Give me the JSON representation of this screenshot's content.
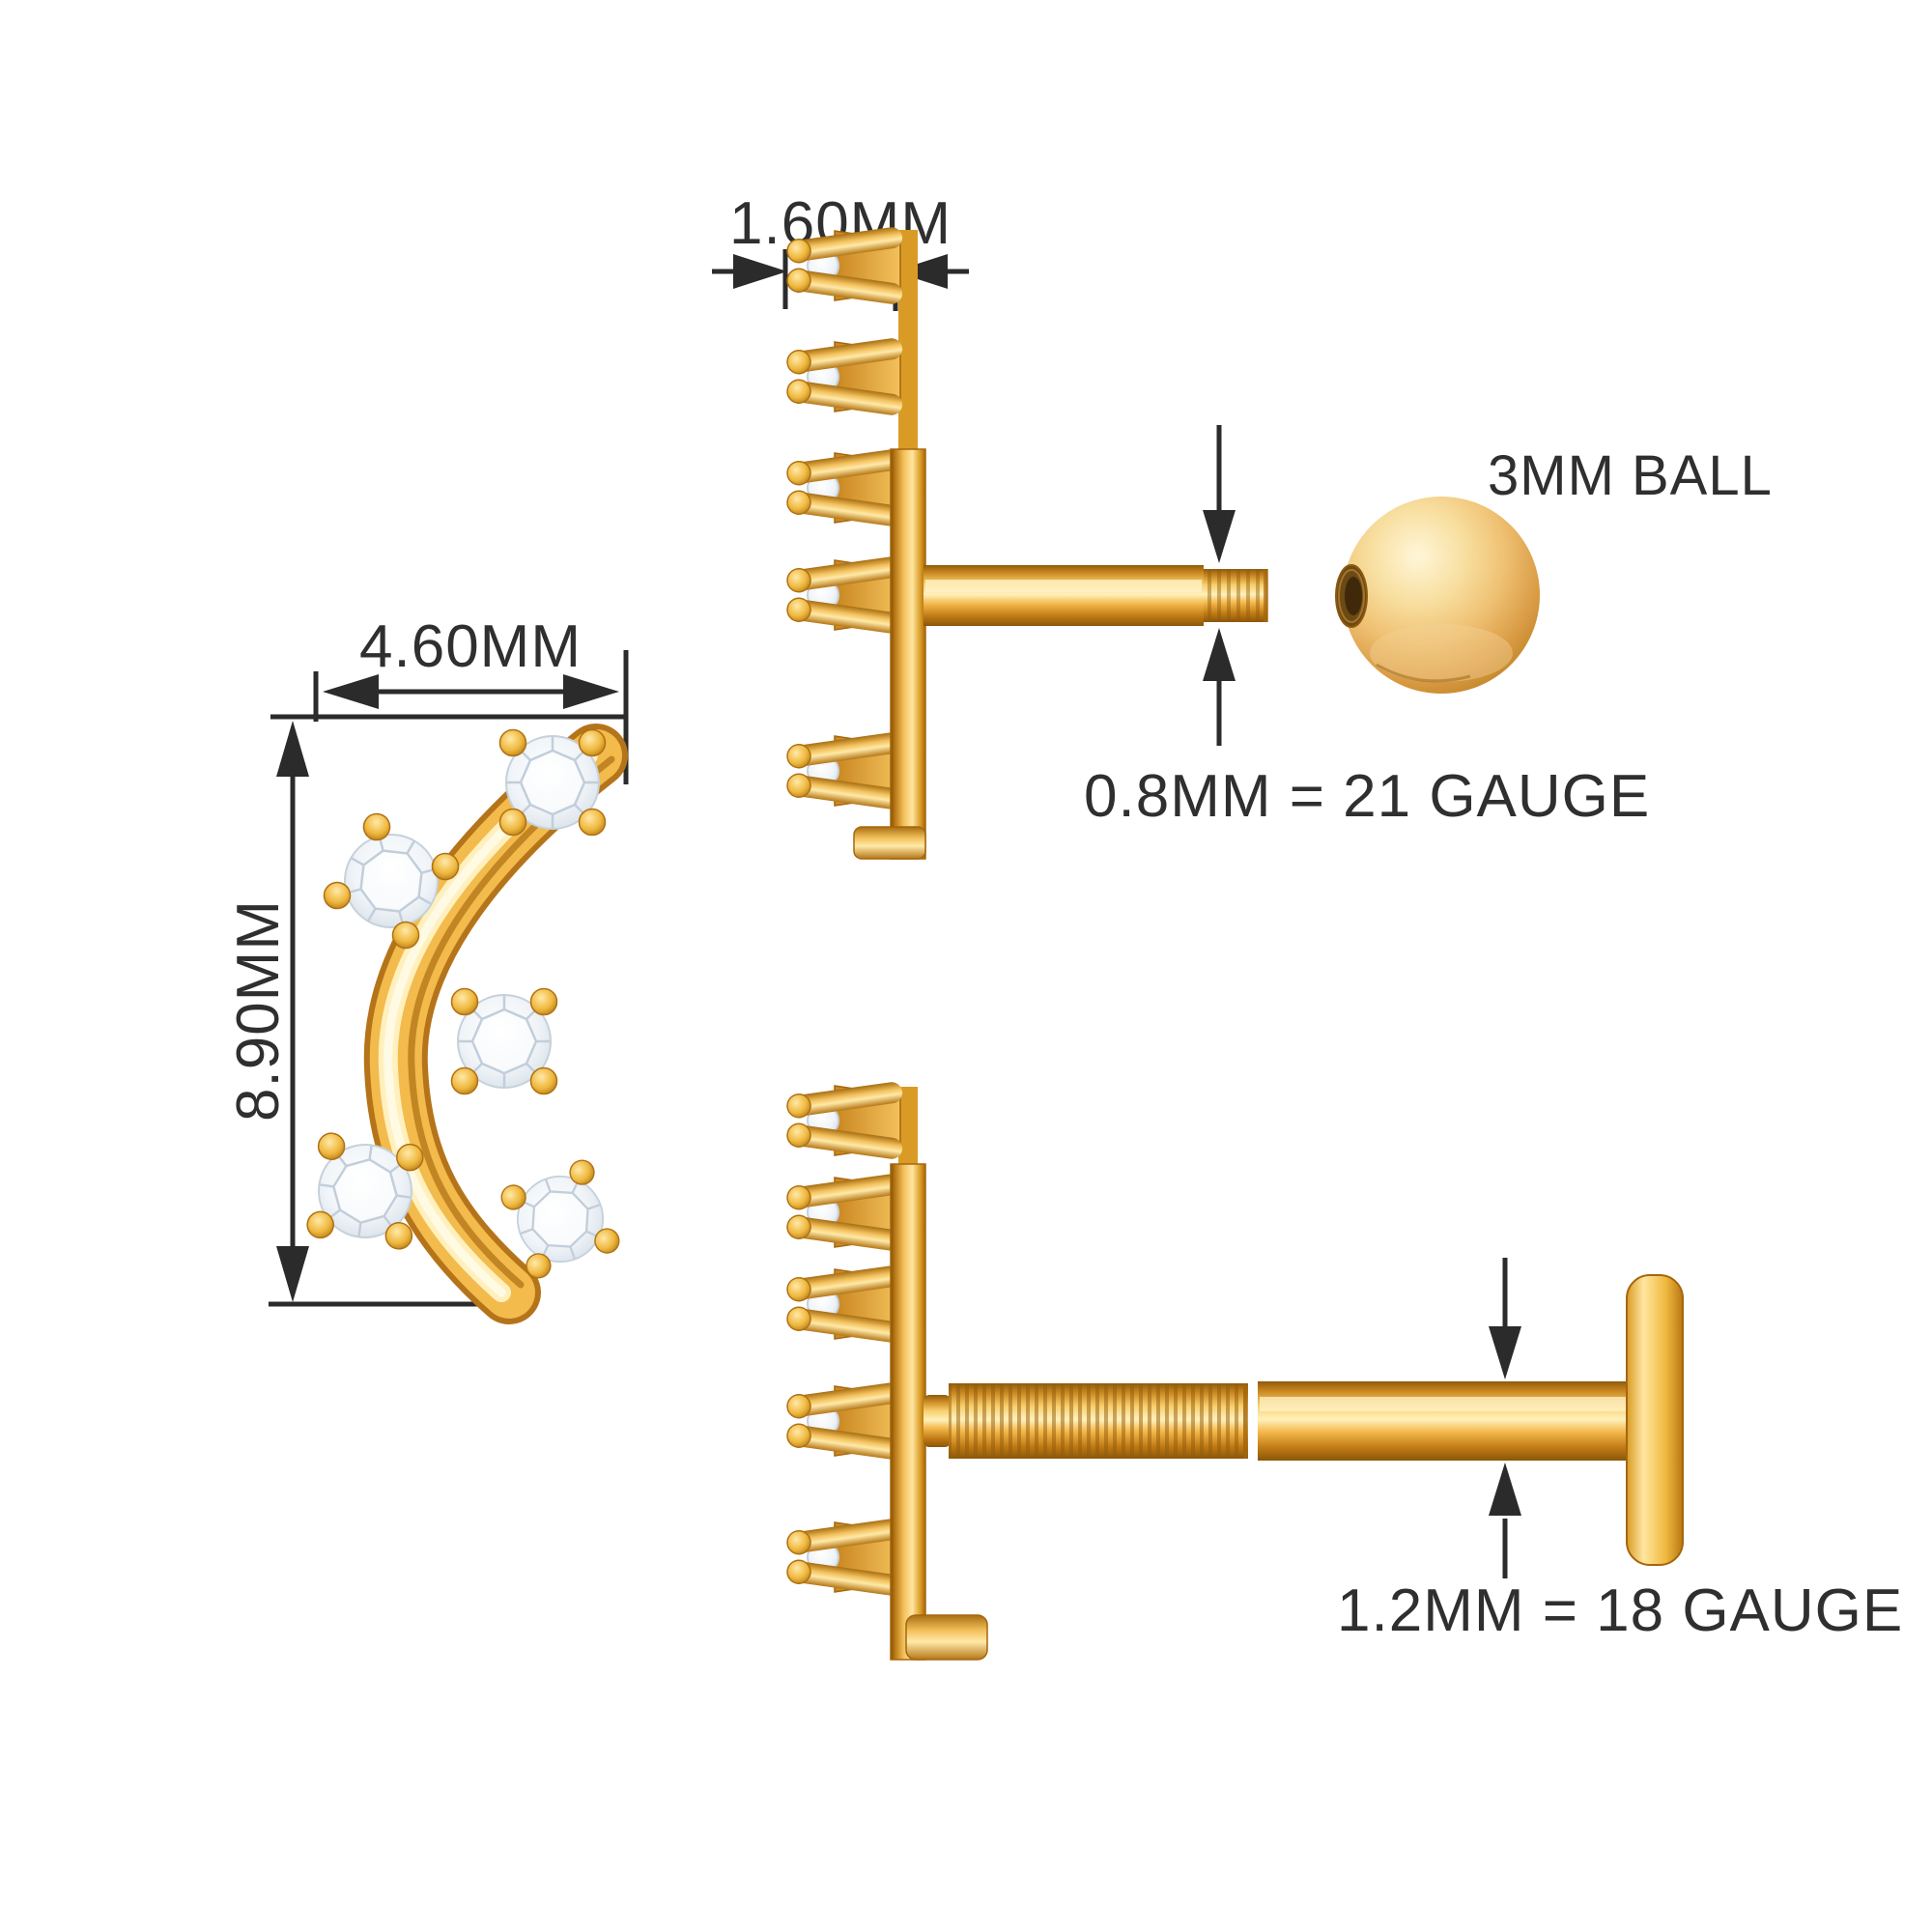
{
  "page": {
    "background": "#ffffff",
    "kind": "jewelry dimension diagram"
  },
  "annotation": {
    "line_color": "#2b2b2b",
    "text_color": "#2f2f2f"
  },
  "materials": {
    "gold_base": "#F3BA4C",
    "gold_highlight": "#FFF0BE",
    "gold_dark": "#B97712",
    "gold_deep": "#8F5B0C",
    "diamond_fill": "#F2F5F9",
    "diamond_edge": "#C6D1DB"
  },
  "labels": {
    "top_width": "1.60MM",
    "front_width": "4.60MM",
    "front_height": "8.90MM",
    "ball": "3MM BALL",
    "top_gauge": "0.8MM = 21 GAUGE",
    "bottom_gauge": "1.2MM = 18 GAUGE"
  }
}
